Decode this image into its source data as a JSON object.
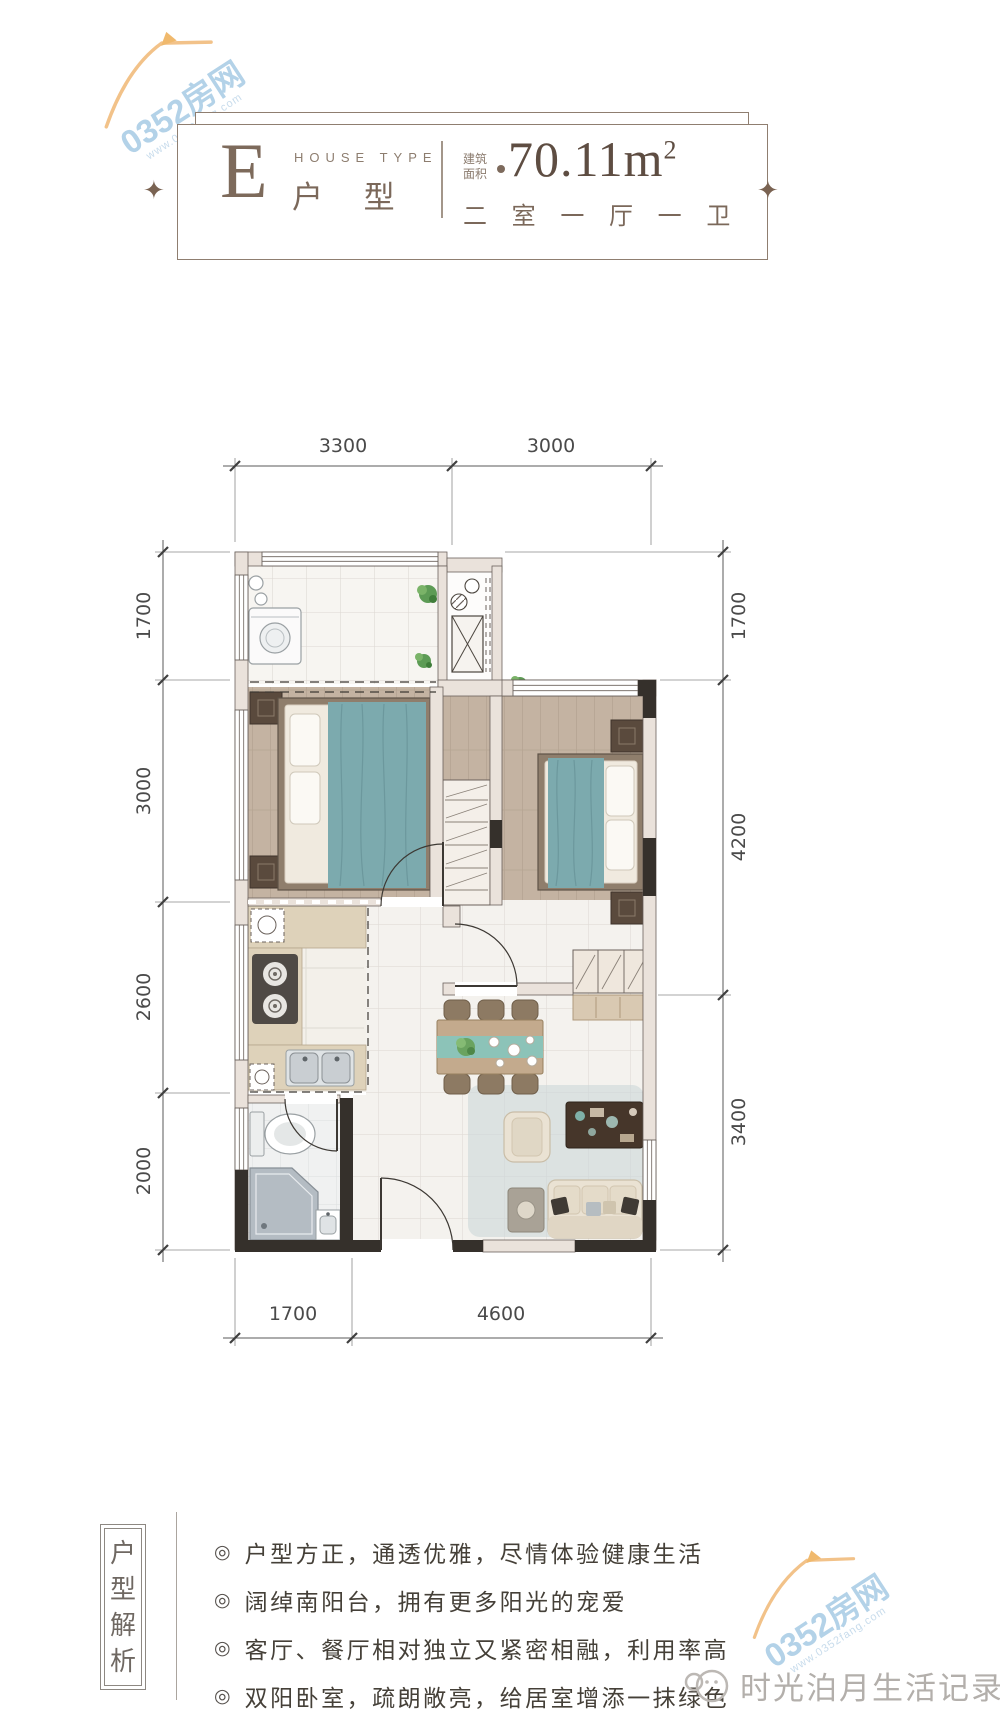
{
  "header": {
    "type_letter": "E",
    "type_label_en": "HOUSE TYPE",
    "type_label_cn": "户 型",
    "area_label_line1": "建筑",
    "area_label_line2": "面积",
    "area_value": "70.11m",
    "area_sup": "2",
    "layout_text": "二 室 一 厅 一 卫",
    "diamond_glyph": "✦"
  },
  "floorplan": {
    "dims_top": [
      "3300",
      "3000"
    ],
    "dims_left": [
      "1700",
      "3000",
      "2600",
      "2000"
    ],
    "dims_right": [
      "1700",
      "4200",
      "3400"
    ],
    "dims_bottom": [
      "1700",
      "4600"
    ]
  },
  "analysis": {
    "title_chars": [
      "户",
      "型",
      "解",
      "析"
    ],
    "bullet_marker": "◎",
    "bullets": [
      {
        "text": "户型方正，通透优雅，尽情体验健康生活"
      },
      {
        "text": "阔绰南阳台，拥有更多阳光的宠爱"
      },
      {
        "text": "客厅、餐厅相对独立又紧密相融，利用率高"
      },
      {
        "text": "双阳卧室，疏朗敞亮，给居室增添一抹绿色"
      }
    ]
  },
  "watermarks": {
    "brand": "0352房网",
    "brand_url": "www.0352fang.com",
    "publisher": "时光泊月生活记录者"
  },
  "colors": {
    "accent_brown": "#7d6a5c",
    "teal_textile": "#7caaae",
    "watermark_blue": "#b3d2e8",
    "watermark_orange": "#f2c289",
    "wall_dark": "#35302b",
    "wall_light": "#eae2db"
  }
}
